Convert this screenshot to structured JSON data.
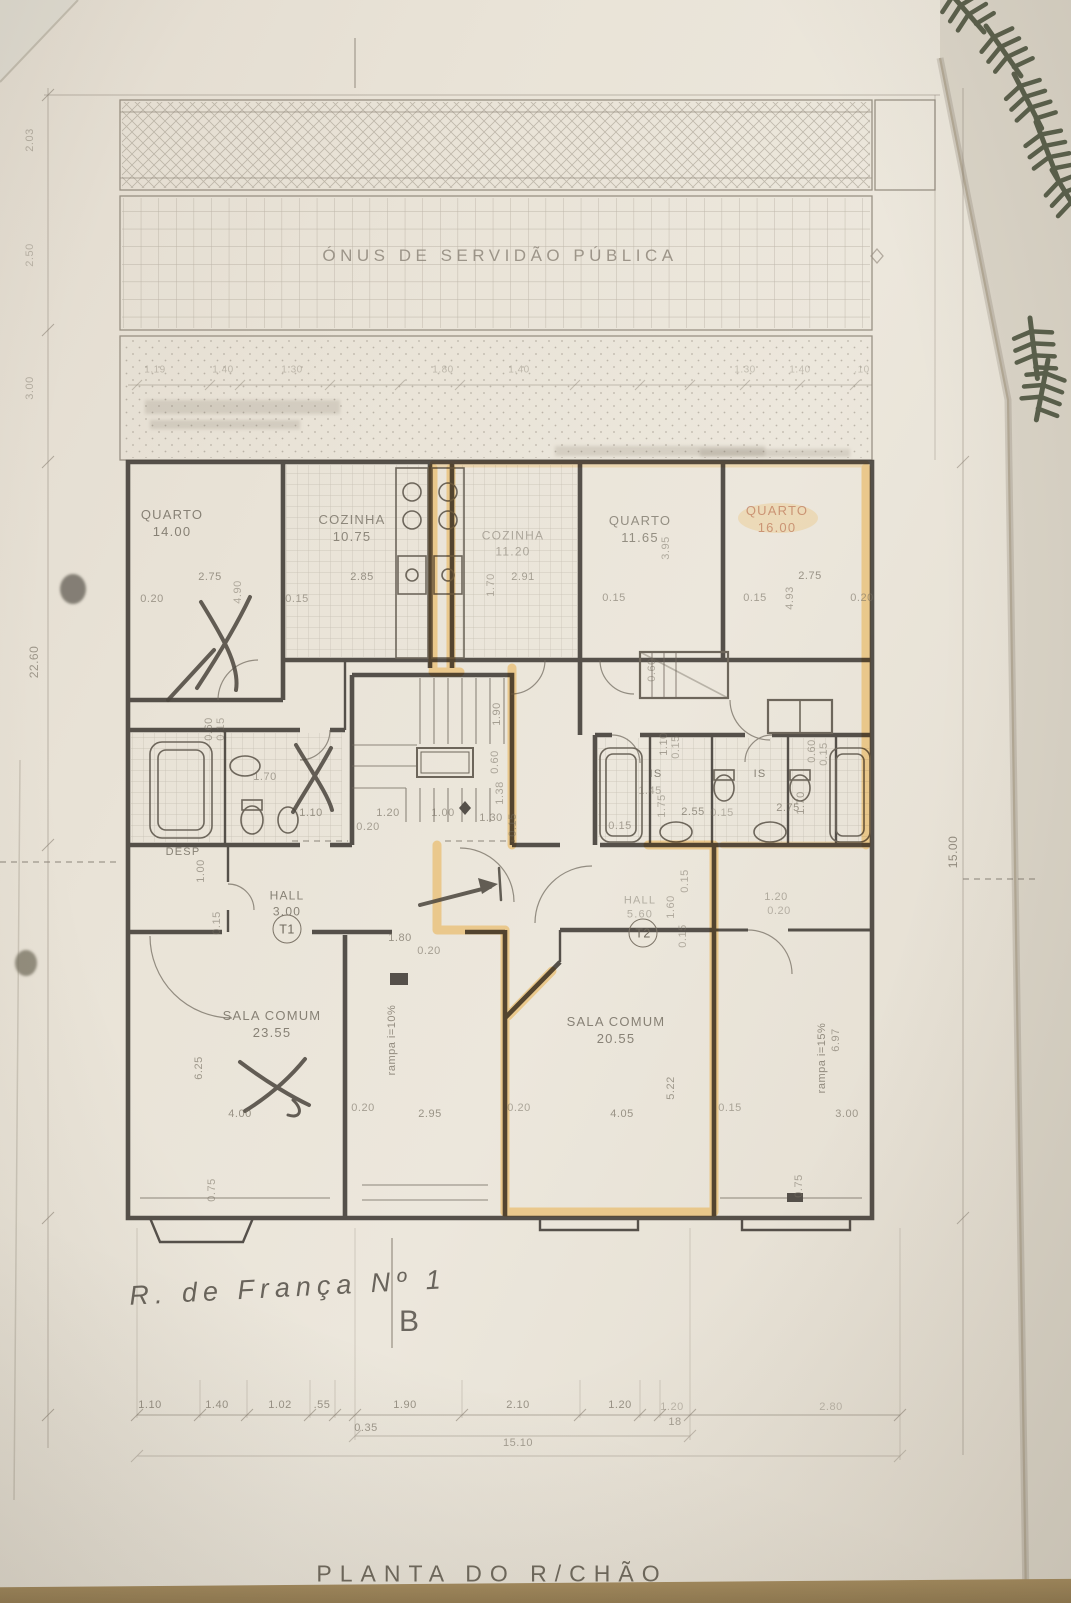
{
  "photo": {
    "table_color": "#97825b",
    "paper_color": "#eae4d9"
  },
  "colors": {
    "pencil": "#7b7366",
    "wall": "#45403a",
    "highlight": "#e8a42c",
    "plant": "#49503b"
  },
  "plan": {
    "servitude_text": "ÓNUS DE SERVIDÃO PÚBLICA",
    "sheet_title": "PLANTA DO R/CHÃO",
    "handwritten_note": "R. de França Nº 1",
    "section_letter": "B",
    "unit_tags": [
      {
        "t": "T1",
        "x": 287,
        "y": 929
      },
      {
        "t": "T2",
        "x": 643,
        "y": 933
      }
    ],
    "rooms": [
      {
        "name": "QUARTO",
        "area": "14.00",
        "x": 172,
        "y": 524,
        "s": 13,
        "o": 0.8
      },
      {
        "name": "COZINHA",
        "area": "10.75",
        "x": 352,
        "y": 529,
        "s": 13,
        "o": 0.75
      },
      {
        "name": "COZINHA",
        "area": "11.20",
        "x": 513,
        "y": 544,
        "s": 12,
        "o": 0.5
      },
      {
        "name": "QUARTO",
        "area": "11.65",
        "x": 640,
        "y": 530,
        "s": 13,
        "o": 0.7
      },
      {
        "name": "QUARTO",
        "area": "16.00",
        "x": 777,
        "y": 520,
        "s": 13,
        "o": 0.75,
        "c": "#c07d5e"
      },
      {
        "name": "SALA COMUM",
        "area": "23.55",
        "x": 272,
        "y": 1025,
        "s": 13,
        "o": 0.8
      },
      {
        "name": "SALA COMUM",
        "area": "20.55",
        "x": 616,
        "y": 1031,
        "s": 13,
        "o": 0.8
      },
      {
        "name": "HALL",
        "area": "3.00",
        "x": 287,
        "y": 904,
        "s": 12,
        "o": 0.8
      },
      {
        "name": "HALL",
        "area": "5.60",
        "x": 640,
        "y": 908,
        "s": 11,
        "o": 0.45
      },
      {
        "name": "DESP",
        "area": "",
        "x": 183,
        "y": 852,
        "s": 11,
        "o": 0.8
      },
      {
        "name": "IS",
        "area": "",
        "x": 656,
        "y": 774,
        "s": 11,
        "o": 0.8
      },
      {
        "name": "IS",
        "area": "",
        "x": 760,
        "y": 774,
        "s": 11,
        "o": 0.8
      }
    ],
    "dims": [
      {
        "t": "2.03",
        "x": 30,
        "y": 140,
        "r": -90,
        "o": 0.45
      },
      {
        "t": "2.50",
        "x": 30,
        "y": 255,
        "r": -90,
        "o": 0.4
      },
      {
        "t": "3.00",
        "x": 30,
        "y": 388,
        "r": -90,
        "o": 0.45
      },
      {
        "t": "22.60",
        "x": 34,
        "y": 662,
        "r": -90,
        "o": 0.65,
        "s": 12
      },
      {
        "t": "15.00",
        "x": 953,
        "y": 852,
        "r": -90,
        "o": 0.75,
        "s": 12
      },
      {
        "t": "1.19",
        "x": 155,
        "y": 370,
        "o": 0.38,
        "s": 10
      },
      {
        "t": "1.40",
        "x": 223,
        "y": 370,
        "o": 0.38,
        "s": 10
      },
      {
        "t": "1.30",
        "x": 292,
        "y": 370,
        "o": 0.38,
        "s": 10
      },
      {
        "t": "1.80",
        "x": 443,
        "y": 370,
        "o": 0.38,
        "s": 10
      },
      {
        "t": "1.40",
        "x": 519,
        "y": 370,
        "o": 0.38,
        "s": 10
      },
      {
        "t": "1.30",
        "x": 745,
        "y": 370,
        "o": 0.35,
        "s": 10
      },
      {
        "t": "1.40",
        "x": 800,
        "y": 370,
        "o": 0.35,
        "s": 10
      },
      {
        "t": ".10",
        "x": 862,
        "y": 370,
        "o": 0.35,
        "s": 10
      },
      {
        "t": "2.75",
        "x": 210,
        "y": 577,
        "o": 0.7
      },
      {
        "t": "0.20",
        "x": 152,
        "y": 599,
        "o": 0.65
      },
      {
        "t": "4.90",
        "x": 238,
        "y": 592,
        "r": -90,
        "o": 0.5
      },
      {
        "t": "0.15",
        "x": 297,
        "y": 599,
        "o": 0.6
      },
      {
        "t": "2.85",
        "x": 362,
        "y": 577,
        "o": 0.7
      },
      {
        "t": "1.70",
        "x": 491,
        "y": 585,
        "r": -90,
        "o": 0.5
      },
      {
        "t": "2.91",
        "x": 523,
        "y": 577,
        "o": 0.6
      },
      {
        "t": "0.15",
        "x": 614,
        "y": 598,
        "o": 0.6
      },
      {
        "t": "3.95",
        "x": 666,
        "y": 548,
        "r": -90,
        "o": 0.5
      },
      {
        "t": "2.75",
        "x": 810,
        "y": 576,
        "o": 0.7
      },
      {
        "t": "0.15",
        "x": 755,
        "y": 598,
        "o": 0.6
      },
      {
        "t": "0.20",
        "x": 862,
        "y": 598,
        "o": 0.6
      },
      {
        "t": "4.93",
        "x": 790,
        "y": 598,
        "r": -90,
        "o": 0.55
      },
      {
        "t": "0.60",
        "x": 209,
        "y": 729,
        "r": -90,
        "o": 0.6
      },
      {
        "t": "0.15",
        "x": 221,
        "y": 729,
        "r": -90,
        "o": 0.5
      },
      {
        "t": "1.70",
        "x": 265,
        "y": 777,
        "o": 0.6
      },
      {
        "t": "1.10",
        "x": 311,
        "y": 813,
        "o": 0.7
      },
      {
        "t": "0.60",
        "x": 652,
        "y": 670,
        "r": -90,
        "o": 0.5
      },
      {
        "t": "1.10",
        "x": 664,
        "y": 744,
        "r": -90,
        "o": 0.6
      },
      {
        "t": "0.15",
        "x": 676,
        "y": 747,
        "r": -90,
        "o": 0.5
      },
      {
        "t": "1.45",
        "x": 650,
        "y": 791,
        "o": 0.5
      },
      {
        "t": "1.75",
        "x": 662,
        "y": 806,
        "r": -90,
        "o": 0.5
      },
      {
        "t": "2.55",
        "x": 693,
        "y": 812,
        "o": 0.7
      },
      {
        "t": "0.15",
        "x": 620,
        "y": 826,
        "o": 0.6
      },
      {
        "t": "2.75",
        "x": 788,
        "y": 808,
        "o": 0.7
      },
      {
        "t": "1.70",
        "x": 801,
        "y": 803,
        "r": -90,
        "o": 0.6
      },
      {
        "t": "0.60",
        "x": 812,
        "y": 751,
        "r": -90,
        "o": 0.55
      },
      {
        "t": "0.15",
        "x": 824,
        "y": 754,
        "r": -90,
        "o": 0.5
      },
      {
        "t": "0.15",
        "x": 722,
        "y": 813,
        "o": 0.45
      },
      {
        "t": "1.90",
        "x": 497,
        "y": 714,
        "r": -90,
        "o": 0.6
      },
      {
        "t": "0.60",
        "x": 495,
        "y": 762,
        "r": -90,
        "o": 0.55
      },
      {
        "t": "1.38",
        "x": 500,
        "y": 793,
        "r": -90,
        "o": 0.55
      },
      {
        "t": "1.20",
        "x": 388,
        "y": 813,
        "o": 0.65
      },
      {
        "t": "1.00",
        "x": 443,
        "y": 813,
        "o": 0.6
      },
      {
        "t": "1.30",
        "x": 491,
        "y": 818,
        "o": 0.65
      },
      {
        "t": "0.20",
        "x": 368,
        "y": 827,
        "o": 0.6
      },
      {
        "t": "0.15",
        "x": 513,
        "y": 825,
        "r": -90,
        "o": 0.5
      },
      {
        "t": "1.00",
        "x": 201,
        "y": 871,
        "r": -90,
        "o": 0.6
      },
      {
        "t": "0.15",
        "x": 217,
        "y": 923,
        "r": -90,
        "o": 0.55
      },
      {
        "t": "1.80",
        "x": 400,
        "y": 938,
        "o": 0.7
      },
      {
        "t": "0.20",
        "x": 429,
        "y": 951,
        "o": 0.6
      },
      {
        "t": "1.60",
        "x": 671,
        "y": 907,
        "r": -90,
        "o": 0.5
      },
      {
        "t": "0.15",
        "x": 685,
        "y": 881,
        "r": -90,
        "o": 0.5
      },
      {
        "t": "0.15",
        "x": 683,
        "y": 936,
        "r": -90,
        "o": 0.5
      },
      {
        "t": "1.20",
        "x": 776,
        "y": 897,
        "o": 0.5
      },
      {
        "t": "0.20",
        "x": 779,
        "y": 911,
        "o": 0.45
      },
      {
        "t": "rampa  i=10%",
        "x": 392,
        "y": 1040,
        "r": -90,
        "o": 0.75
      },
      {
        "t": "rampa  i=15%",
        "x": 822,
        "y": 1058,
        "r": -90,
        "o": 0.75
      },
      {
        "t": "6.25",
        "x": 199,
        "y": 1068,
        "r": -90,
        "o": 0.65
      },
      {
        "t": "4.00",
        "x": 240,
        "y": 1114,
        "o": 0.7
      },
      {
        "t": "0.20",
        "x": 363,
        "y": 1108,
        "o": 0.6
      },
      {
        "t": "2.95",
        "x": 430,
        "y": 1114,
        "o": 0.7
      },
      {
        "t": "0.20",
        "x": 519,
        "y": 1108,
        "o": 0.55
      },
      {
        "t": "4.05",
        "x": 622,
        "y": 1114,
        "o": 0.7
      },
      {
        "t": "5.22",
        "x": 671,
        "y": 1088,
        "r": -90,
        "o": 0.65
      },
      {
        "t": "0.15",
        "x": 730,
        "y": 1108,
        "o": 0.55
      },
      {
        "t": "3.00",
        "x": 847,
        "y": 1114,
        "o": 0.65
      },
      {
        "t": "6.97",
        "x": 836,
        "y": 1040,
        "r": -90,
        "o": 0.6
      },
      {
        "t": "0.75",
        "x": 212,
        "y": 1190,
        "r": -90,
        "o": 0.55
      },
      {
        "t": "0.75",
        "x": 799,
        "y": 1186,
        "r": -90,
        "o": 0.55
      },
      {
        "t": "1.10",
        "x": 150,
        "y": 1405,
        "o": 0.7
      },
      {
        "t": "1.40",
        "x": 217,
        "y": 1405,
        "o": 0.7
      },
      {
        "t": "1.02",
        "x": 280,
        "y": 1405,
        "o": 0.7
      },
      {
        "t": ".55",
        "x": 322,
        "y": 1405,
        "o": 0.7
      },
      {
        "t": "1.90",
        "x": 405,
        "y": 1405,
        "o": 0.7
      },
      {
        "t": "2.10",
        "x": 518,
        "y": 1405,
        "o": 0.7
      },
      {
        "t": "1.20",
        "x": 620,
        "y": 1405,
        "o": 0.7
      },
      {
        "t": "1.20",
        "x": 672,
        "y": 1407,
        "o": 0.4
      },
      {
        "t": "2.80",
        "x": 831,
        "y": 1407,
        "o": 0.4
      },
      {
        "t": "0.35",
        "x": 366,
        "y": 1428,
        "o": 0.65
      },
      {
        "t": "18",
        "x": 675,
        "y": 1422,
        "o": 0.6
      },
      {
        "t": "15.10",
        "x": 518,
        "y": 1443,
        "o": 0.6
      }
    ]
  }
}
